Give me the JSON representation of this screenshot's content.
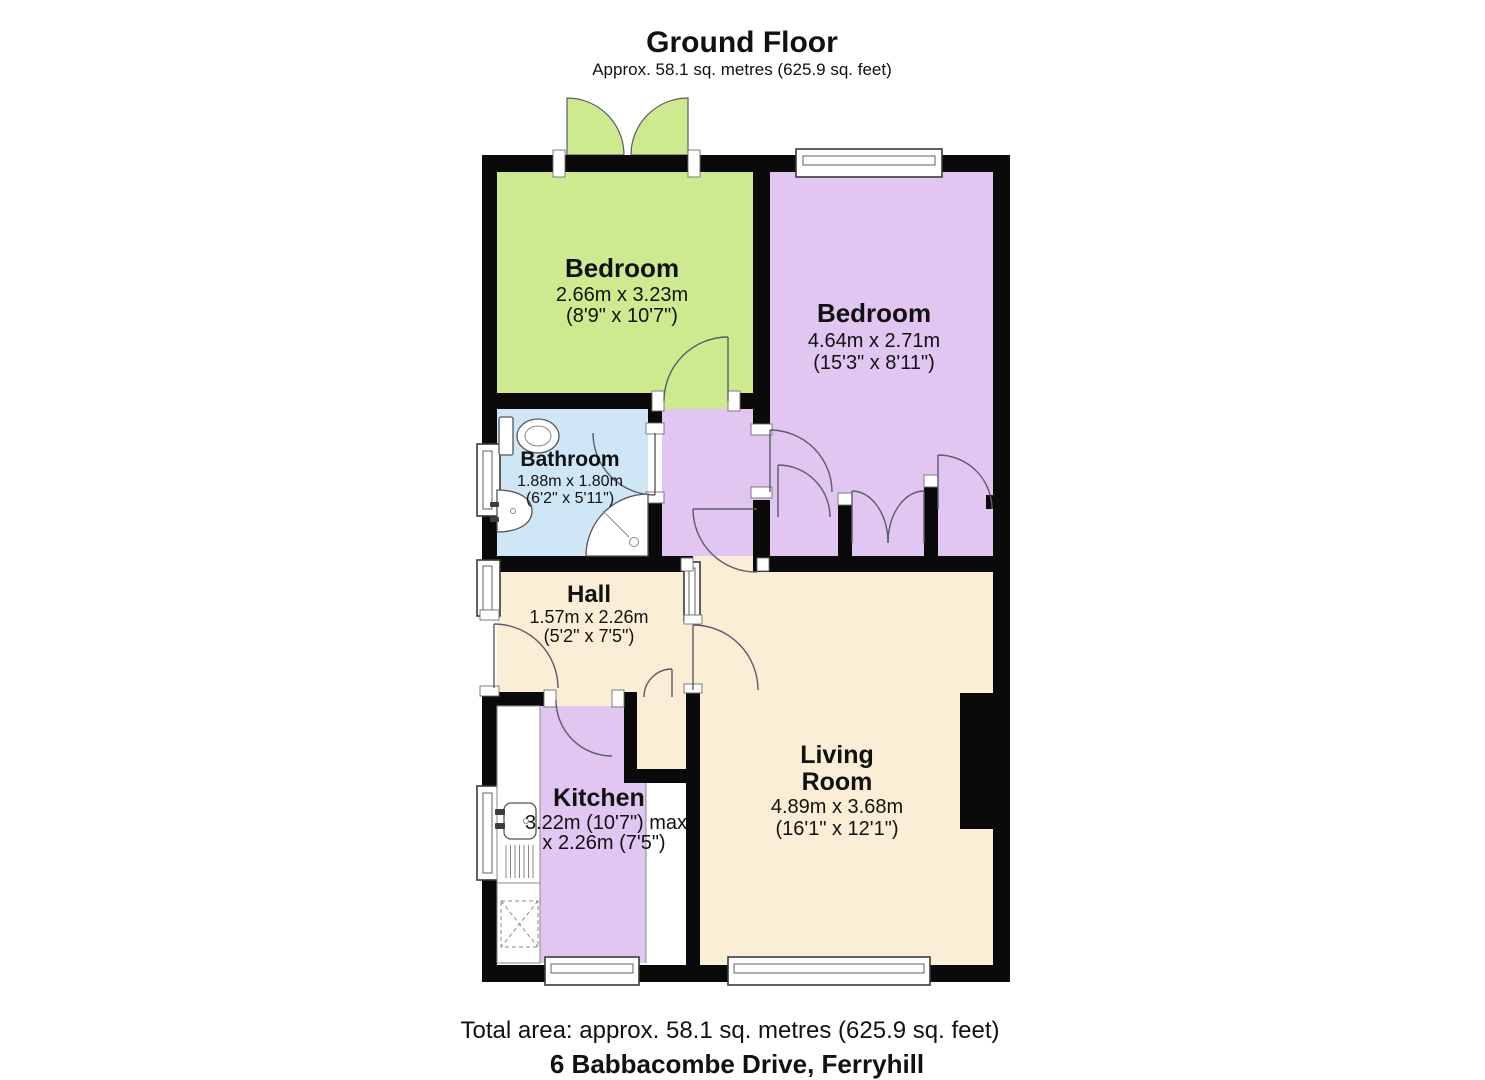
{
  "header": {
    "title": "Ground Floor",
    "subtitle": "Approx. 58.1 sq. metres (625.9 sq. feet)"
  },
  "footer": {
    "total_area": "Total area: approx. 58.1 sq. metres (625.9 sq. feet)",
    "address": "6 Babbacombe Drive, Ferryhill"
  },
  "rooms": {
    "bedroom1": {
      "name": "Bedroom",
      "dims_metric": "2.66m x 3.23m",
      "dims_imperial": "(8'9\" x 10'7\")"
    },
    "bedroom2": {
      "name": "Bedroom",
      "dims_metric": "4.64m x 2.71m",
      "dims_imperial": "(15'3\" x 8'11\")"
    },
    "bathroom": {
      "name": "Bathroom",
      "dims_metric": "1.88m x 1.80m",
      "dims_imperial": "(6'2\" x 5'11\")"
    },
    "hall": {
      "name": "Hall",
      "dims_metric": "1.57m x 2.26m",
      "dims_imperial": "(5'2\" x 7'5\")"
    },
    "kitchen": {
      "name": "Kitchen",
      "dims_line1": "3.22m (10'7\") max",
      "dims_line2": "x 2.26m (7'5\")"
    },
    "living": {
      "name_line1": "Living",
      "name_line2": "Room",
      "dims_metric": "4.89m x 3.68m",
      "dims_imperial": "(16'1\" x 12'1\")"
    }
  },
  "colors": {
    "green": "#cdea8e",
    "purple": "#e0c6f0",
    "blue": "#cfe6f7",
    "cream": "#fbeed6",
    "wall": "#0a0a0a",
    "arc": "#5b5b6b",
    "fixture": "#555555",
    "window_frame": "#3a3a3a",
    "text": "#111111"
  }
}
